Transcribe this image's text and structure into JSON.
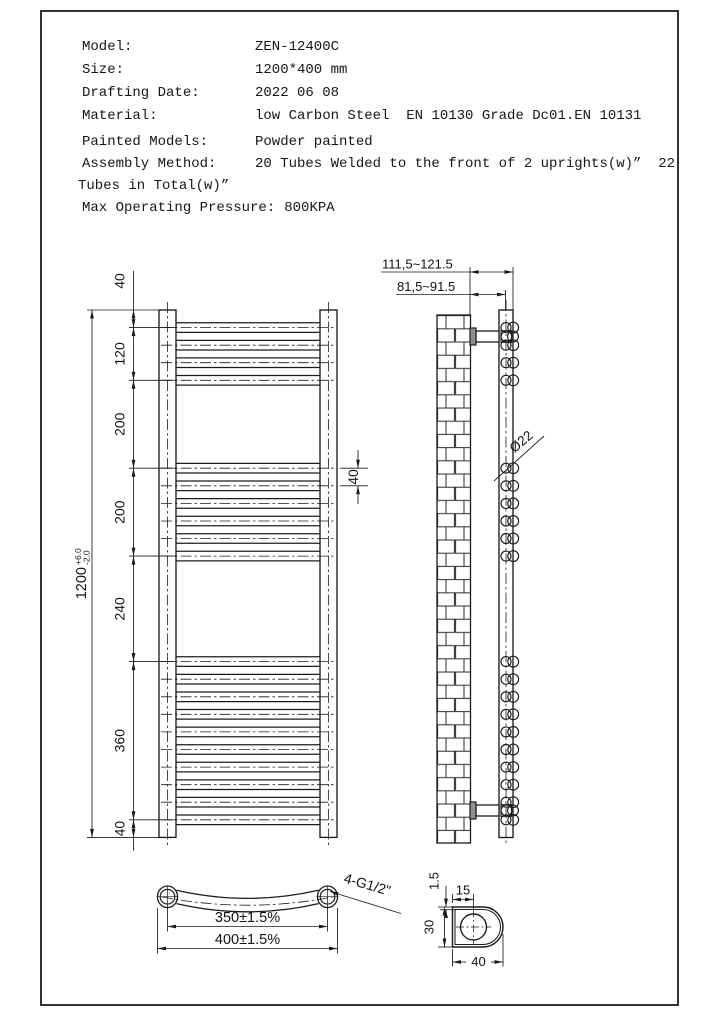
{
  "title_block": {
    "rows": [
      {
        "label": "Model:",
        "value": "ZEN-12400C"
      },
      {
        "label": "Size:",
        "value": "1200*400 mm"
      },
      {
        "label": "Drafting Date:",
        "value": "2022 06 08"
      },
      {
        "label": "Material:",
        "value": "low Carbon Steel  EN 10130 Grade Dc01.EN 10131"
      },
      {
        "label": "Painted Models:",
        "value": "Powder painted"
      },
      {
        "label": "Assembly Method:",
        "value": "20 Tubes Welded to the front of 2 uprights(w)”  22"
      },
      {
        "label": "",
        "value": "Tubes in Total(w)”"
      },
      {
        "label": "Max Operating Pressure:",
        "value": "800KPA"
      }
    ]
  },
  "front_view": {
    "overall": {
      "value": "1200",
      "tol_plus": "+6.0",
      "tol_minus": "-2.0"
    },
    "chain_labels": [
      "40",
      "120",
      "200",
      "200",
      "240",
      "360",
      "40"
    ],
    "tube_spacing_label": "40",
    "boundaries_mm": [
      0,
      40,
      160,
      360,
      560,
      800,
      1160,
      1200
    ],
    "tube_groups": [
      {
        "count": 4
      },
      {
        "count": 6
      },
      {
        "count": 10
      }
    ]
  },
  "side_view": {
    "wall_to_front": "111,5~121.5",
    "wall_to_center": "81,5~91.5",
    "tube_diameter": "Ø22"
  },
  "plan_view": {
    "center_distance": "350±1.5%",
    "overall_width": "400±1.5%",
    "thread": "4-G1/2\""
  },
  "section_view": {
    "wall_thickness": "1.5",
    "hole_offset": "15",
    "depth": "30",
    "width": "40"
  }
}
